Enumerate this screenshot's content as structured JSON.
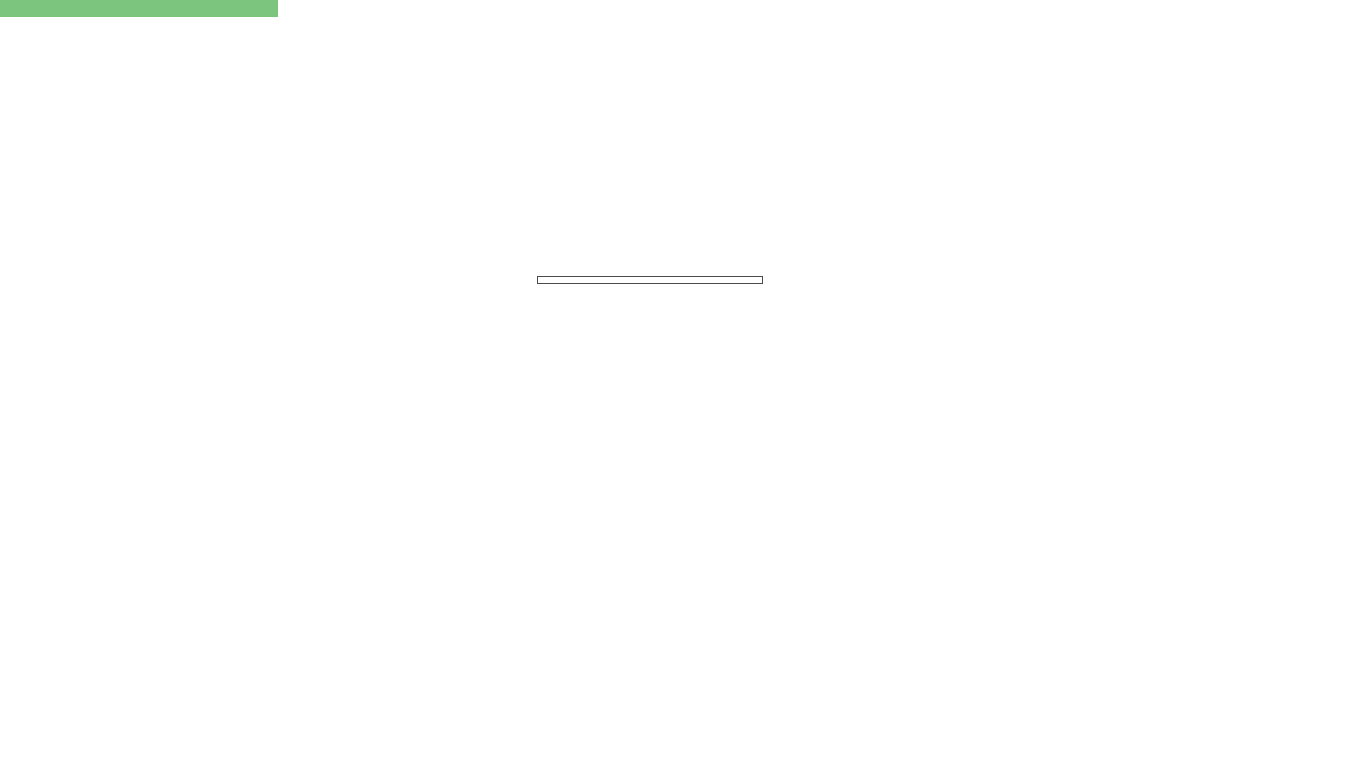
{
  "info_box": {
    "line1": "Sup. Parcela:  3858.43 m2",
    "line2": "Edificabilidad: 1234.69 m2"
  },
  "watermark": "www.procareestates.com",
  "terrain_note": "exc. grava",
  "parcels": [
    {
      "id": "PARCELA 1",
      "tipo": "TIPO A",
      "area": "459.00 m2",
      "jardin": "Jardin Anexo",
      "jardin_area": "226.54"
    },
    {
      "id": "PARCELA 2",
      "tipo": "TIPO B",
      "area": "409.43 m2",
      "jardin": "Jardin Anexo",
      "jardin_area": "203.84"
    },
    {
      "id": "PARCELA 3",
      "tipo": "TIPO B",
      "area": "409.43 m2",
      "jardin": "Jardin Anexo",
      "jardin_area": "203.36"
    },
    {
      "id": "PARCELA 4",
      "tipo": "TIPO B",
      "area": "409.43 m2",
      "jardin": "Jardin Anexo",
      "jardin_area": "204.93"
    },
    {
      "id": "PARCELA 5",
      "tipo": "TIPO C",
      "area": "409.43 m2",
      "jardin": "Jardin Anexo",
      "jardin_area": "210.61"
    },
    {
      "id": "PARCELA 6",
      "tipo": "TIPO C",
      "area": "409.43 m2",
      "jardin": "Jardin Anexo",
      "jardin_area": "218.31"
    },
    {
      "id": "PARCELA 7",
      "tipo": "TIPO C",
      "area": "409.43 m2",
      "jardin": "Jardin Anexo",
      "jardin_area": "198.58"
    },
    {
      "id": "PARCELA 8",
      "tipo": "TIPO C",
      "area": "409.43 m2",
      "jardin": "Jardin Anexo",
      "jardin_area": "232.43"
    },
    {
      "id": "PARCELA 9",
      "tipo": "TIPO D",
      "area": "533.40 m2",
      "jardin": "Jardin Anexo",
      "jardin_area": "437.96"
    }
  ],
  "colors": {
    "parcel_green": "#a8cc57",
    "pool_blue": "#c3e5f1",
    "boundary_red": "#c44444",
    "path_beige": "#ece4da",
    "terrain_gray": "#b6b6b6",
    "label_red": "#cf4f4f",
    "garden_green": "#3c7427",
    "header_green": "#7cc57e"
  }
}
